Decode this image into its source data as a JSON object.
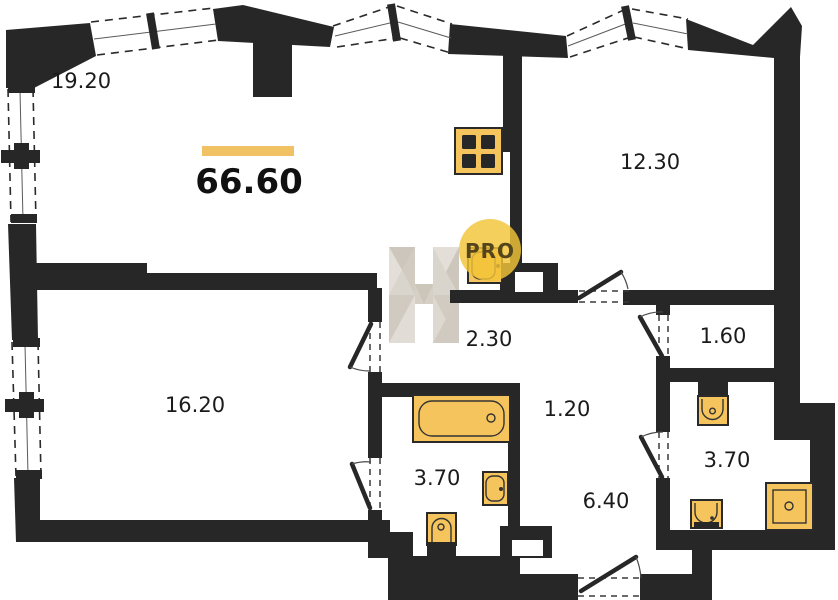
{
  "plan": {
    "total": {
      "area": "66.60"
    },
    "rooms": [
      {
        "key": "living-room",
        "area": "19.20"
      },
      {
        "key": "bedroom",
        "area": "12.30"
      },
      {
        "key": "bedroom-2",
        "area": "16.20"
      },
      {
        "key": "corridor",
        "area": "2.30"
      },
      {
        "key": "corridor-small",
        "area": "1.20"
      },
      {
        "key": "bathroom",
        "area": "3.70"
      },
      {
        "key": "hallway",
        "area": "6.40"
      },
      {
        "key": "storage",
        "area": "1.60"
      },
      {
        "key": "bathroom-2",
        "area": "3.70"
      }
    ],
    "fixtures": [
      "kitchen-stove",
      "kitchen-sink",
      "bathtub",
      "washbasin",
      "toilet",
      "toilet-2",
      "washbasin-2",
      "shower"
    ],
    "watermark": {
      "badge_text": "PRO",
      "logo": "H"
    },
    "colors": {
      "wall": "#272727",
      "fixture_fill": "#f6c45c",
      "fixture_stroke": "#2a2a2a",
      "accent_bar": "#f0c263",
      "badge_fill": "#f3c437",
      "watermark_gray": "#d8d3cb"
    }
  }
}
